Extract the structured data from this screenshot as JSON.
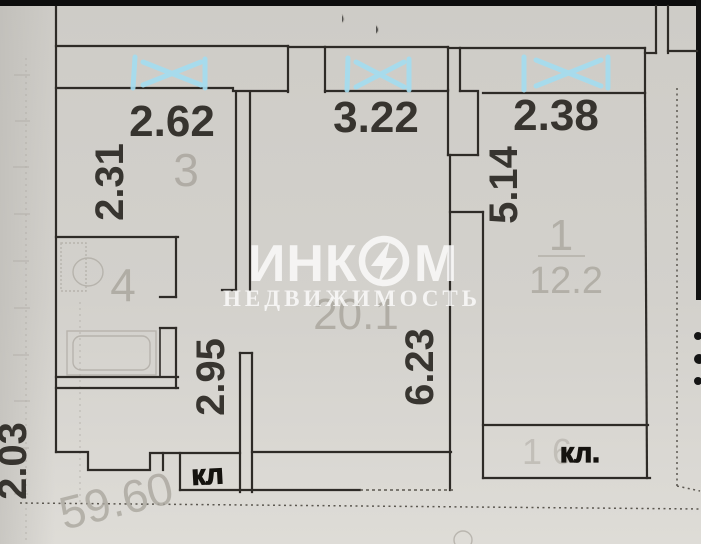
{
  "document": {
    "kind_label": "floor-plan-scan"
  },
  "watermark": {
    "brand_left": "ИНК",
    "brand_right": "М",
    "subtitle": "НЕДВИЖИМОСТЬ"
  },
  "labels": {
    "d262": "2.62",
    "d322": "3.22",
    "d238": "2.38",
    "d231": "2.31",
    "d514": "5.14",
    "d295": "2.95",
    "d623": "6.23",
    "d203": "2.03"
  },
  "rooms": {
    "room3": "3",
    "room4": "4",
    "room1": "1",
    "room1_area": "12.2",
    "living_area": "20.1",
    "total_area": "59.60",
    "closet_faint": "16"
  },
  "annotations": {
    "hall_closet": "кл",
    "room1_closet": "кл."
  },
  "colors": {
    "paper": "#d2d0cb",
    "wall_line": "#2e2b27",
    "pencil": "#aba79f",
    "window_mark": "#a3ddf0",
    "scan_strip": "#0d0d0d",
    "marker_ink": "#15130f",
    "watermark": "#ffffff"
  }
}
